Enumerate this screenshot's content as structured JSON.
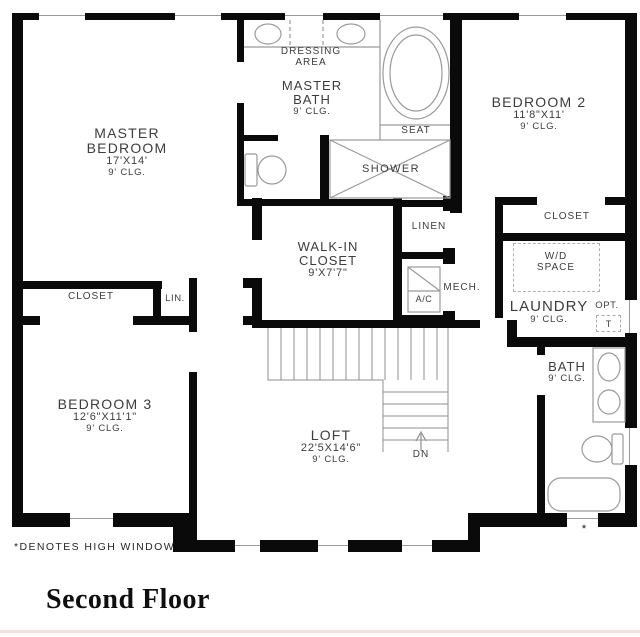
{
  "title": "Second Floor",
  "footnote": "*DENOTES HIGH WINDOW",
  "high_window_marker": "*",
  "rooms": {
    "master_bedroom": {
      "l1": "MASTER",
      "l2": "BEDROOM",
      "dims": "17'X14'",
      "clg": "9' CLG."
    },
    "dressing_area": {
      "l1": "DRESSING",
      "l2": "AREA"
    },
    "master_bath": {
      "l1": "MASTER",
      "l2": "BATH",
      "clg": "9' CLG."
    },
    "bedroom_2": {
      "l1": "BEDROOM 2",
      "dims": "11'8\"X11'",
      "clg": "9' CLG."
    },
    "walk_in_closet": {
      "l1": "WALK-IN",
      "l2": "CLOSET",
      "dims": "9'X7'7\""
    },
    "bedroom_3": {
      "l1": "BEDROOM 3",
      "dims": "12'6\"X11'1\"",
      "clg": "9' CLG."
    },
    "loft": {
      "l1": "LOFT",
      "dims": "22'5X14'6\"",
      "clg": "9' CLG."
    },
    "laundry": {
      "l1": "LAUNDRY",
      "clg": "9' CLG."
    },
    "bath": {
      "l1": "BATH",
      "clg": "9' CLG."
    }
  },
  "features": {
    "seat": "SEAT",
    "shower": "SHOWER",
    "closet_bedroom2": "CLOSET",
    "closet_bedroom3": "CLOSET",
    "linen": "LINEN",
    "lin_small": "LIN.",
    "mech": "MECH.",
    "ac": "A/C",
    "wd_l1": "W/D",
    "wd_l2": "SPACE",
    "opt": "OPT.",
    "opt_t": "T",
    "down": "DN"
  },
  "colors": {
    "wall": "#0a0a0a",
    "fixture": "#9a9a9a",
    "text": "#3d3d3d",
    "page_edge": "#f5e1e2"
  }
}
